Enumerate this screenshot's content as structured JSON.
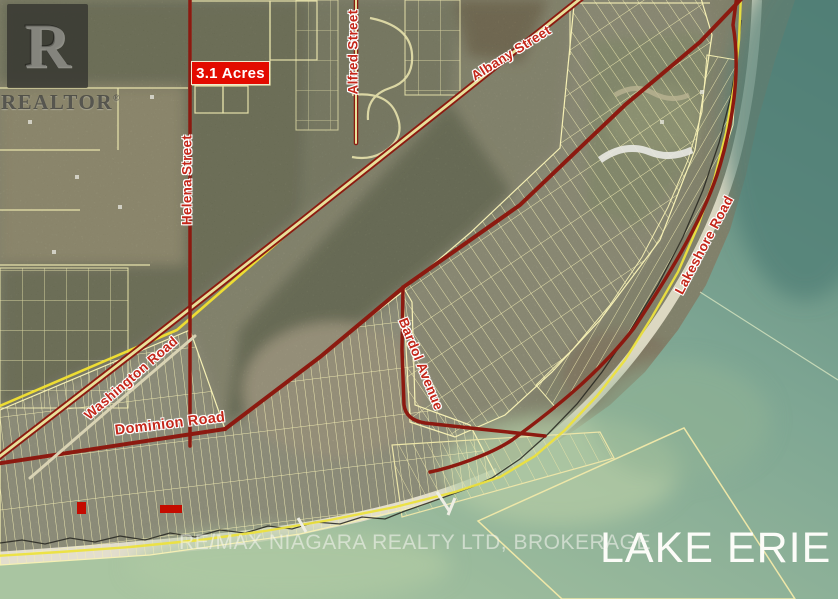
{
  "branding": {
    "logo_letter": "R",
    "wordmark": "REALTOR",
    "registered": "®",
    "watermark": "RE/MAX NIAGARA REALTY LTD, BROKERAGE"
  },
  "labels": {
    "acreage": "3.1 Acres",
    "water_body": "LAKE ERIE"
  },
  "streets": {
    "helena": {
      "label": "Helena Street"
    },
    "alfred": {
      "label": "Alfred Street"
    },
    "albany": {
      "label": "Albany Street"
    },
    "washington": {
      "label": "Washington Road"
    },
    "dominion": {
      "label": "Dominion Road"
    },
    "bardol": {
      "label": "Bardol Avenue"
    },
    "lakeshore": {
      "label": "Lakeshore Road"
    }
  },
  "colors": {
    "road": "#8c1a10",
    "parcel_line": "#f6f0b4",
    "street_label": "#c4271a",
    "highlight_box": "#e30b00",
    "railway": "#eedd33",
    "water_deep": "#568279",
    "water_shallow": "#a9c5a1",
    "land": "#8d8c70"
  }
}
